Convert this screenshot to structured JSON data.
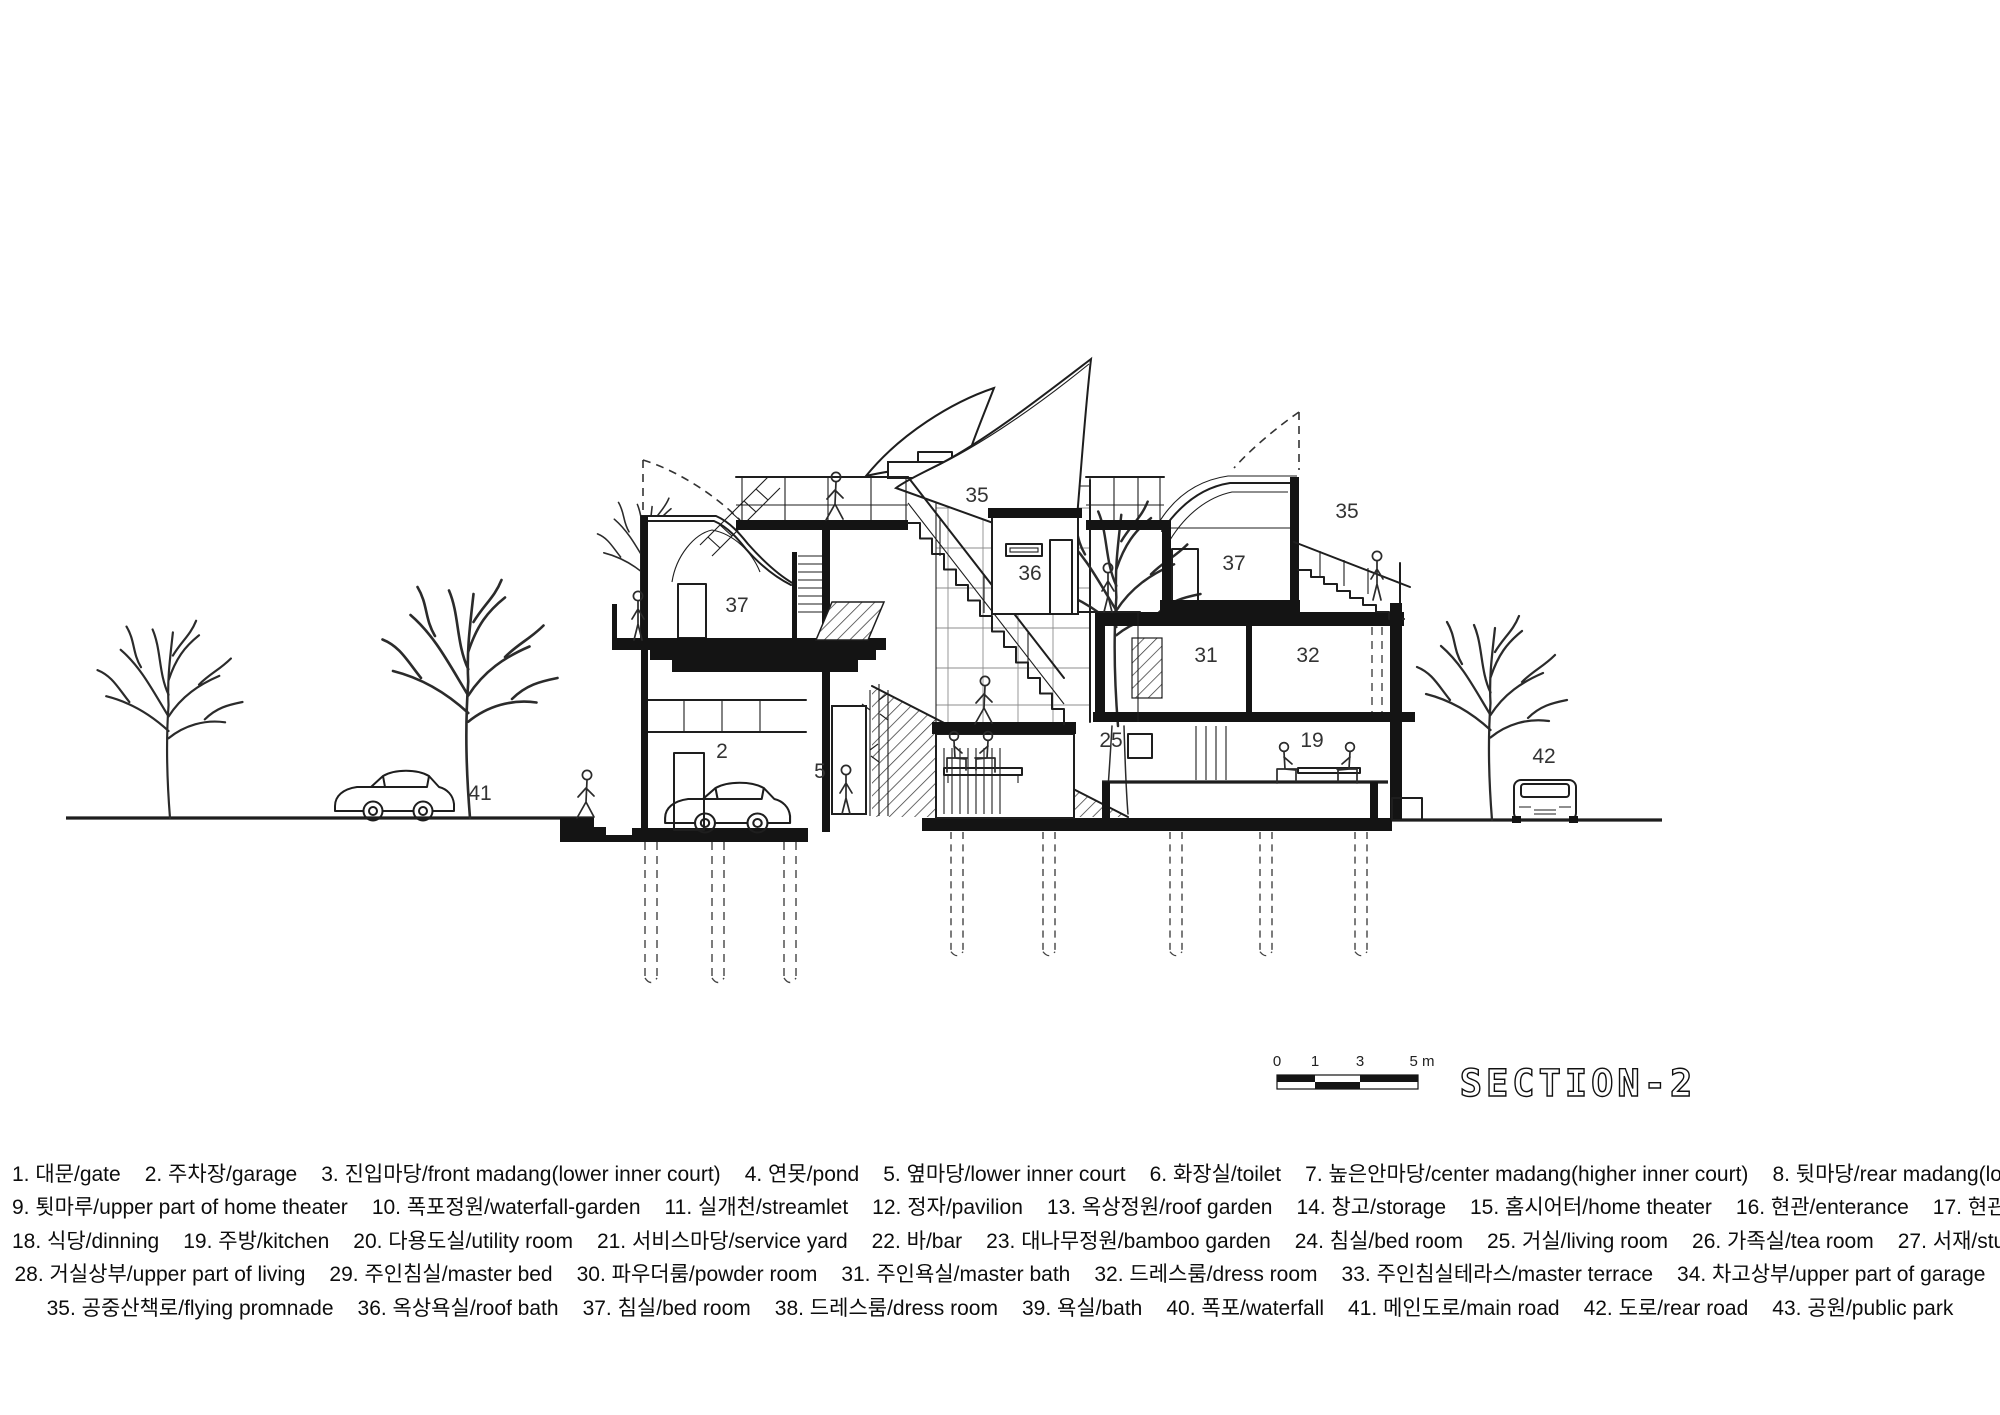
{
  "title": "SECTION-2",
  "scale_bar": {
    "ticks": [
      "0",
      "1",
      "3",
      "5 m"
    ]
  },
  "drawing_labels": [
    {
      "text": "35",
      "x": 977,
      "y": 502
    },
    {
      "text": "36",
      "x": 1030,
      "y": 580
    },
    {
      "text": "37",
      "x": 737,
      "y": 612
    },
    {
      "text": "37",
      "x": 1234,
      "y": 570
    },
    {
      "text": "35",
      "x": 1347,
      "y": 518
    },
    {
      "text": "31",
      "x": 1206,
      "y": 662
    },
    {
      "text": "32",
      "x": 1308,
      "y": 662
    },
    {
      "text": "25",
      "x": 1111,
      "y": 747
    },
    {
      "text": "19",
      "x": 1312,
      "y": 747
    },
    {
      "text": "2",
      "x": 722,
      "y": 758
    },
    {
      "text": "5",
      "x": 820,
      "y": 778
    },
    {
      "text": "41",
      "x": 480,
      "y": 800
    },
    {
      "text": "42",
      "x": 1544,
      "y": 763
    }
  ],
  "legend": {
    "rows": [
      [
        "1. 대문/gate",
        "2. 주차장/garage",
        "3. 진입마당/front madang(lower inner court)",
        "4. 연못/pond",
        "5. 옆마당/lower inner court",
        "6. 화장실/toilet",
        "7. 높은안마당/center madang(higher inner court)",
        "8. 뒷마당/rear madang(lower inner court)"
      ],
      [
        "9. 툇마루/upper part of home theater",
        "10. 폭포정원/waterfall-garden",
        "11. 실개천/streamlet",
        "12. 정자/pavilion",
        "13. 옥상정원/roof garden",
        "14. 창고/storage",
        "15. 홈시어터/home theater",
        "16. 현관/enterance",
        "17. 현관홀/enterance hall"
      ],
      [
        "18. 식당/dinning",
        "19. 주방/kitchen",
        "20. 다용도실/utility room",
        "21. 서비스마당/service yard",
        "22. 바/bar",
        "23. 대나무정원/bamboo garden",
        "24. 침실/bed room",
        "25. 거실/living room",
        "26. 가족실/tea room",
        "27. 서재/study room"
      ],
      [
        "28. 거실상부/upper part of living",
        "29. 주인침실/master bed",
        "30. 파우더룸/powder room",
        "31. 주인욕실/master bath",
        "32. 드레스룸/dress room",
        "33. 주인침실테라스/master terrace",
        "34. 차고상부/upper part of garage"
      ],
      [
        "35. 공중산책로/flying promnade",
        "36. 옥상욕실/roof bath",
        "37. 침실/bed room",
        "38. 드레스룸/dress room",
        "39. 욕실/bath",
        "40. 폭포/waterfall",
        "41. 메인도로/main road",
        "42. 도로/rear road",
        "43. 공원/public park"
      ]
    ]
  }
}
